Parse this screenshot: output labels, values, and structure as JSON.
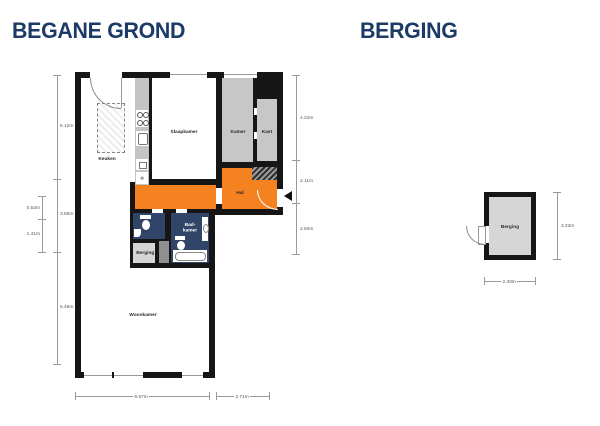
{
  "titles": {
    "main": "BEGANE GROND",
    "secondary": "BERGING"
  },
  "colors": {
    "title_navy": "#1c3a67",
    "hal_orange": "#f58220",
    "wet_room_navy": "#304567",
    "room_gray": "#c7c7c7",
    "storage_gray": "#d6d6d6",
    "wall_black": "#161616"
  },
  "plan": {
    "labels": {
      "keuken": "Keuken",
      "slaapkamer": "Slaapkamer",
      "kamer": "Kamer",
      "kast": "Kast",
      "hal": "Hal",
      "badkamer": "Bad-\nkamer",
      "berging": "Berging",
      "woonkamer": "Woonkamer"
    },
    "dimensions": {
      "left": [
        "5.12m",
        "3.55m",
        "5.49m"
      ],
      "far_left": [
        "0.52m",
        "1.41m"
      ],
      "right": [
        "4.22m",
        "2.11m",
        "2.50m"
      ],
      "bottom": [
        "6.57m",
        "2.71m"
      ]
    }
  },
  "storage": {
    "label": "Berging",
    "dimensions": {
      "right": "3.23m",
      "bottom": "2.33m"
    }
  },
  "icons": {
    "fridge": "❄"
  }
}
